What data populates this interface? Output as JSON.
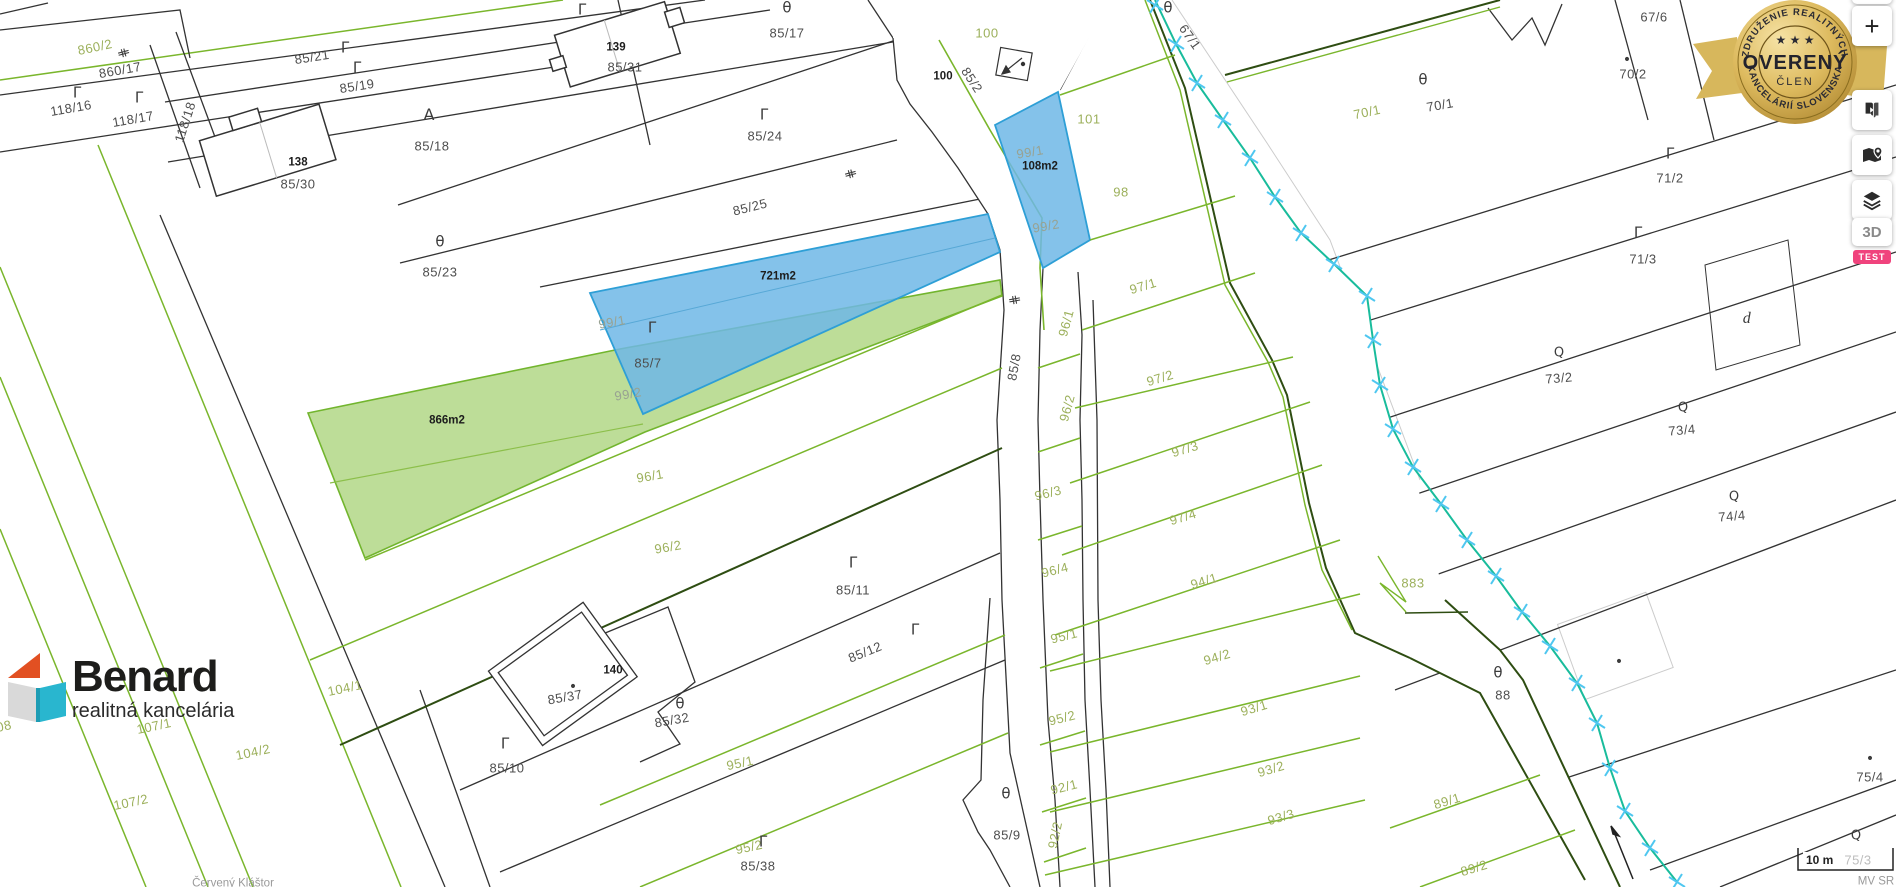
{
  "badge": {
    "arc_top": "ZDRUŽENIE REALITNÝCH",
    "arc_bottom": "KANCELÁRIÍ SLOVENSKA",
    "stars": "★ ★ ★",
    "title": "OVERENÝ",
    "subtitle": "ČLEN"
  },
  "controls": {
    "zoom_in": "+",
    "view_3d": "3D",
    "test_badge": "TEST"
  },
  "logo": {
    "name": "Benard",
    "tagline": "realitná kancelária"
  },
  "scale": {
    "label": "10 m"
  },
  "attribution": "MV SR",
  "watermark": "Červený Kláštor",
  "colors": {
    "highlight_blue_fill": "#6fb7e6",
    "highlight_blue_stroke": "#2e9fd6",
    "highlight_green_fill": "#b6d98d",
    "highlight_green_stroke": "#72b52e",
    "stream": "#19bc9c",
    "stream_marker": "#4fc7f0",
    "line_green": "#7ab62c",
    "line_dark_olive": "#2e4d12",
    "line_black": "#333333",
    "label_green": "#9cb05b",
    "label_dark": "#4e4e4e",
    "test_pink": "#f0437d",
    "badge_gold": "#d7b356"
  },
  "map": {
    "area_labels": {
      "blue_area": "721m2",
      "blue_area_2": "108m2",
      "green_area": "866m2"
    },
    "labels": [
      {
        "t": "860/2",
        "x": 95,
        "y": 47,
        "k": "g",
        "r": -12
      },
      {
        "t": "860/17",
        "x": 120,
        "y": 70,
        "k": "d",
        "r": -10
      },
      {
        "t": "118/16",
        "x": 71,
        "y": 108,
        "k": "d",
        "r": -10
      },
      {
        "t": "118/17",
        "x": 133,
        "y": 119,
        "k": "d",
        "r": -10
      },
      {
        "t": "118/18",
        "x": 185,
        "y": 122,
        "k": "d",
        "r": -72
      },
      {
        "t": "85/21",
        "x": 312,
        "y": 57,
        "k": "d",
        "r": -9
      },
      {
        "t": "85/19",
        "x": 357,
        "y": 86,
        "k": "d",
        "r": -9
      },
      {
        "t": "138",
        "x": 298,
        "y": 163,
        "k": "b",
        "r": 0
      },
      {
        "t": "85/30",
        "x": 298,
        "y": 184,
        "k": "d",
        "r": 0
      },
      {
        "t": "85/18",
        "x": 432,
        "y": 146,
        "k": "d",
        "r": 0
      },
      {
        "t": "139",
        "x": 616,
        "y": 48,
        "k": "b",
        "r": 0
      },
      {
        "t": "85/31",
        "x": 625,
        "y": 67,
        "k": "d",
        "r": 0
      },
      {
        "t": "85/17",
        "x": 787,
        "y": 33,
        "k": "d",
        "r": 0
      },
      {
        "t": "85/24",
        "x": 765,
        "y": 136,
        "k": "d",
        "r": 0
      },
      {
        "t": "85/25",
        "x": 750,
        "y": 207,
        "k": "d",
        "r": -14
      },
      {
        "t": "85/23",
        "x": 440,
        "y": 272,
        "k": "d",
        "r": 0
      },
      {
        "t": "85/7",
        "x": 648,
        "y": 363,
        "k": "d",
        "r": 0
      },
      {
        "t": "99/1",
        "x": 612,
        "y": 322,
        "k": "m",
        "r": -10
      },
      {
        "t": "99/2",
        "x": 628,
        "y": 394,
        "k": "m",
        "r": -10
      },
      {
        "t": "721m2",
        "x": 778,
        "y": 277,
        "k": "b",
        "r": 0
      },
      {
        "t": "866m2",
        "x": 447,
        "y": 421,
        "k": "b",
        "r": 0
      },
      {
        "t": "96/1",
        "x": 650,
        "y": 476,
        "k": "g",
        "r": -10
      },
      {
        "t": "96/2",
        "x": 668,
        "y": 547,
        "k": "g",
        "r": -10
      },
      {
        "t": "100",
        "x": 987,
        "y": 33,
        "k": "g",
        "r": 0
      },
      {
        "t": "100",
        "x": 943,
        "y": 77,
        "k": "b",
        "r": 0
      },
      {
        "t": "85/2",
        "x": 972,
        "y": 80,
        "k": "d",
        "r": 57
      },
      {
        "t": "99/1",
        "x": 1030,
        "y": 152,
        "k": "m",
        "r": -10
      },
      {
        "t": "108m2",
        "x": 1040,
        "y": 167,
        "k": "b",
        "r": 0
      },
      {
        "t": "99/2",
        "x": 1046,
        "y": 226,
        "k": "m",
        "r": -10
      },
      {
        "t": "101",
        "x": 1089,
        "y": 119,
        "k": "g",
        "r": 0
      },
      {
        "t": "98",
        "x": 1121,
        "y": 192,
        "k": "g",
        "r": 0
      },
      {
        "t": "85/8",
        "x": 1014,
        "y": 367,
        "k": "d",
        "r": -80
      },
      {
        "t": "96/1",
        "x": 1066,
        "y": 323,
        "k": "g",
        "r": -75
      },
      {
        "t": "96/2",
        "x": 1067,
        "y": 408,
        "k": "g",
        "r": -75
      },
      {
        "t": "96/3",
        "x": 1048,
        "y": 493,
        "k": "g",
        "r": -14
      },
      {
        "t": "96/4",
        "x": 1055,
        "y": 570,
        "k": "g",
        "r": -14
      },
      {
        "t": "97/1",
        "x": 1143,
        "y": 286,
        "k": "g",
        "r": -17
      },
      {
        "t": "97/2",
        "x": 1160,
        "y": 378,
        "k": "g",
        "r": -17
      },
      {
        "t": "97/3",
        "x": 1185,
        "y": 449,
        "k": "g",
        "r": -17
      },
      {
        "t": "97/4",
        "x": 1183,
        "y": 517,
        "k": "g",
        "r": -17
      },
      {
        "t": "94/1",
        "x": 1204,
        "y": 581,
        "k": "g",
        "r": -17
      },
      {
        "t": "94/2",
        "x": 1217,
        "y": 657,
        "k": "g",
        "r": -17
      },
      {
        "t": "93/1",
        "x": 1254,
        "y": 708,
        "k": "g",
        "r": -17
      },
      {
        "t": "93/2",
        "x": 1271,
        "y": 769,
        "k": "g",
        "r": -17
      },
      {
        "t": "93/3",
        "x": 1281,
        "y": 817,
        "k": "g",
        "r": -17
      },
      {
        "t": "95/1",
        "x": 1064,
        "y": 636,
        "k": "g",
        "r": -14
      },
      {
        "t": "95/2",
        "x": 1062,
        "y": 718,
        "k": "g",
        "r": -14
      },
      {
        "t": "92/1",
        "x": 1064,
        "y": 787,
        "k": "g",
        "r": -14
      },
      {
        "t": "92/2",
        "x": 1055,
        "y": 835,
        "k": "g",
        "r": -78
      },
      {
        "t": "85/11",
        "x": 853,
        "y": 590,
        "k": "d",
        "r": 0
      },
      {
        "t": "85/12",
        "x": 865,
        "y": 652,
        "k": "d",
        "r": -22
      },
      {
        "t": "140",
        "x": 613,
        "y": 671,
        "k": "b",
        "r": 0
      },
      {
        "t": "85/37",
        "x": 565,
        "y": 697,
        "k": "d",
        "r": -10
      },
      {
        "t": "85/32",
        "x": 672,
        "y": 720,
        "k": "d",
        "r": -10
      },
      {
        "t": "85/10",
        "x": 507,
        "y": 768,
        "k": "d",
        "r": 0
      },
      {
        "t": "95/1",
        "x": 740,
        "y": 763,
        "k": "g",
        "r": -12
      },
      {
        "t": "95/2",
        "x": 749,
        "y": 847,
        "k": "g",
        "r": -12
      },
      {
        "t": "85/38",
        "x": 758,
        "y": 866,
        "k": "d",
        "r": 0
      },
      {
        "t": "85/9",
        "x": 1007,
        "y": 835,
        "k": "d",
        "r": 0
      },
      {
        "t": "104/1",
        "x": 345,
        "y": 688,
        "k": "g",
        "r": -12
      },
      {
        "t": "104/2",
        "x": 253,
        "y": 752,
        "k": "g",
        "r": -12
      },
      {
        "t": "107/1",
        "x": 154,
        "y": 726,
        "k": "g",
        "r": -12
      },
      {
        "t": "107/2",
        "x": 131,
        "y": 802,
        "k": "g",
        "r": -12
      },
      {
        "t": "08",
        "x": 4,
        "y": 726,
        "k": "g",
        "r": -12
      },
      {
        "t": "67/1",
        "x": 1190,
        "y": 37,
        "k": "d",
        "r": 55
      },
      {
        "t": "70/1",
        "x": 1367,
        "y": 112,
        "k": "g",
        "r": -12
      },
      {
        "t": "70/1",
        "x": 1440,
        "y": 105,
        "k": "d",
        "r": -10
      },
      {
        "t": "70/2",
        "x": 1633,
        "y": 74,
        "k": "d",
        "r": 0
      },
      {
        "t": "67/6",
        "x": 1654,
        "y": 17,
        "k": "d",
        "r": 0
      },
      {
        "t": "71/2",
        "x": 1670,
        "y": 178,
        "k": "d",
        "r": 0
      },
      {
        "t": "71/3",
        "x": 1643,
        "y": 259,
        "k": "d",
        "r": 0
      },
      {
        "t": "73/2",
        "x": 1559,
        "y": 378,
        "k": "d",
        "r": -5
      },
      {
        "t": "73/4",
        "x": 1682,
        "y": 430,
        "k": "d",
        "r": -5
      },
      {
        "t": "74/4",
        "x": 1732,
        "y": 516,
        "k": "d",
        "r": -5
      },
      {
        "t": "883",
        "x": 1413,
        "y": 583,
        "k": "g",
        "r": 0
      },
      {
        "t": "88",
        "x": 1503,
        "y": 695,
        "k": "d",
        "r": 0
      },
      {
        "t": "89/1",
        "x": 1447,
        "y": 801,
        "k": "g",
        "r": -17
      },
      {
        "t": "89/2",
        "x": 1474,
        "y": 868,
        "k": "g",
        "r": -17
      },
      {
        "t": "75/4",
        "x": 1870,
        "y": 777,
        "k": "d",
        "r": 0
      },
      {
        "t": "75/3",
        "x": 1858,
        "y": 860,
        "k": "lg",
        "r": 0
      },
      {
        "t": "d",
        "x": 1747,
        "y": 319,
        "k": "it",
        "r": 0
      },
      {
        "t": "Červený Kláštor",
        "x": 233,
        "y": 884,
        "k": "wm",
        "r": 0
      },
      {
        "t": "MV SR",
        "x": 1876,
        "y": 882,
        "k": "wm",
        "r": 0
      }
    ],
    "symbols": [
      {
        "glyph": "Γ",
        "x": 345,
        "y": 48,
        "s": 15,
        "r": 0
      },
      {
        "glyph": "Γ",
        "x": 357,
        "y": 68,
        "s": 15,
        "r": 0
      },
      {
        "glyph": "Γ",
        "x": 77,
        "y": 93,
        "s": 15,
        "r": 0
      },
      {
        "glyph": "Γ",
        "x": 139,
        "y": 98,
        "s": 15,
        "r": 0
      },
      {
        "glyph": "Γ",
        "x": 582,
        "y": 10,
        "s": 15,
        "r": 0
      },
      {
        "glyph": "Γ",
        "x": 764,
        "y": 115,
        "s": 15,
        "r": 0
      },
      {
        "glyph": "Γ",
        "x": 652,
        "y": 328,
        "s": 15,
        "r": 0
      },
      {
        "glyph": "Γ",
        "x": 853,
        "y": 563,
        "s": 15,
        "r": 0
      },
      {
        "glyph": "Γ",
        "x": 915,
        "y": 630,
        "s": 15,
        "r": 0
      },
      {
        "glyph": "Γ",
        "x": 505,
        "y": 744,
        "s": 15,
        "r": 0
      },
      {
        "glyph": "Γ",
        "x": 763,
        "y": 842,
        "s": 15,
        "r": 0
      },
      {
        "glyph": "Γ",
        "x": 1670,
        "y": 154,
        "s": 15,
        "r": 0
      },
      {
        "glyph": "Γ",
        "x": 1638,
        "y": 233,
        "s": 15,
        "r": 0
      },
      {
        "glyph": "θ",
        "x": 787,
        "y": 8,
        "s": 15,
        "r": 0
      },
      {
        "glyph": "θ",
        "x": 440,
        "y": 242,
        "s": 15,
        "r": 0
      },
      {
        "glyph": "θ",
        "x": 1168,
        "y": 8,
        "s": 15,
        "r": 0
      },
      {
        "glyph": "θ",
        "x": 1423,
        "y": 80,
        "s": 15,
        "r": 0
      },
      {
        "glyph": "θ",
        "x": 680,
        "y": 704,
        "s": 15,
        "r": 0
      },
      {
        "glyph": "θ",
        "x": 1006,
        "y": 794,
        "s": 15,
        "r": 0
      },
      {
        "glyph": "θ",
        "x": 1498,
        "y": 673,
        "s": 15,
        "r": 0
      },
      {
        "glyph": "Q",
        "x": 1559,
        "y": 353,
        "s": 13,
        "r": 0
      },
      {
        "glyph": "Q",
        "x": 1683,
        "y": 408,
        "s": 13,
        "r": 0
      },
      {
        "glyph": "Q",
        "x": 1734,
        "y": 497,
        "s": 13,
        "r": 0
      },
      {
        "glyph": "Q",
        "x": 1856,
        "y": 836,
        "s": 13,
        "r": 0
      },
      {
        "glyph": "A",
        "x": 429,
        "y": 115,
        "s": 16,
        "r": 0
      },
      {
        "glyph": "⋕",
        "x": 123,
        "y": 53,
        "s": 13,
        "r": 75
      },
      {
        "glyph": "⋕",
        "x": 850,
        "y": 174,
        "s": 13,
        "r": 75
      },
      {
        "glyph": "⋕",
        "x": 1014,
        "y": 300,
        "s": 13,
        "r": 80
      },
      {
        "glyph": "•",
        "x": 573,
        "y": 687,
        "s": 14,
        "r": 0
      },
      {
        "glyph": "•",
        "x": 1627,
        "y": 60,
        "s": 14,
        "r": 0
      },
      {
        "glyph": "•",
        "x": 1870,
        "y": 759,
        "s": 14,
        "r": 0
      },
      {
        "glyph": "•",
        "x": 1619,
        "y": 662,
        "s": 14,
        "r": 0
      }
    ]
  }
}
